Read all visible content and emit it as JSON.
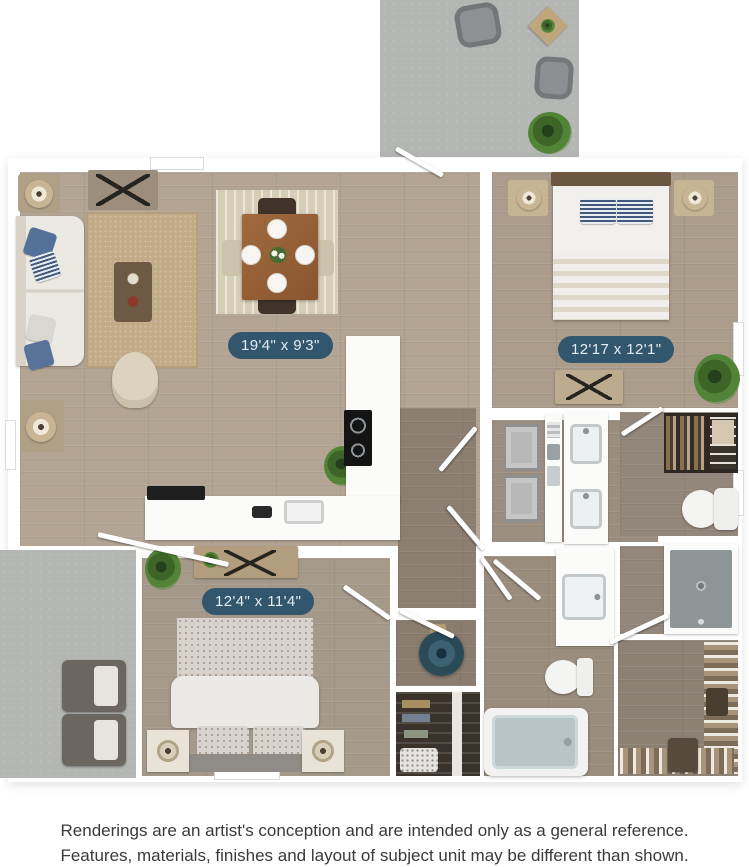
{
  "colors": {
    "background": "#ffffff",
    "wall": "#ffffff",
    "dimension_pill_bg": "#31566d",
    "dimension_pill_text": "#e4ecf2",
    "wood_living": "#b3a494",
    "wood_bedroom1": "#ab9c8b",
    "wood_bedroom2": "#a5998a",
    "wood_hall": "#8c7e70",
    "wood_bath": "#9a8d7d",
    "wood_closet": "#8d8173",
    "patio_concrete": "#b4b6b4",
    "accent_pillow_blue": "#54719a",
    "water_heater_teal": "#3c6170",
    "shower_gray": "#8e9596",
    "tub_basin": "#b7c4c8"
  },
  "rooms": {
    "living_dining_kitchen": {
      "dimension_label": "19'4\" x 9'3\""
    },
    "bedroom_top_right": {
      "dimension_label": "12'17 x 12'1\""
    },
    "bedroom_bottom_left": {
      "dimension_label": "12'4\" x 11'4\""
    }
  },
  "disclaimer": {
    "line1": "Renderings are an artist's conception and are intended only as a general reference.",
    "line2": "Features, materials, finishes and layout of subject unit may be different than shown."
  }
}
